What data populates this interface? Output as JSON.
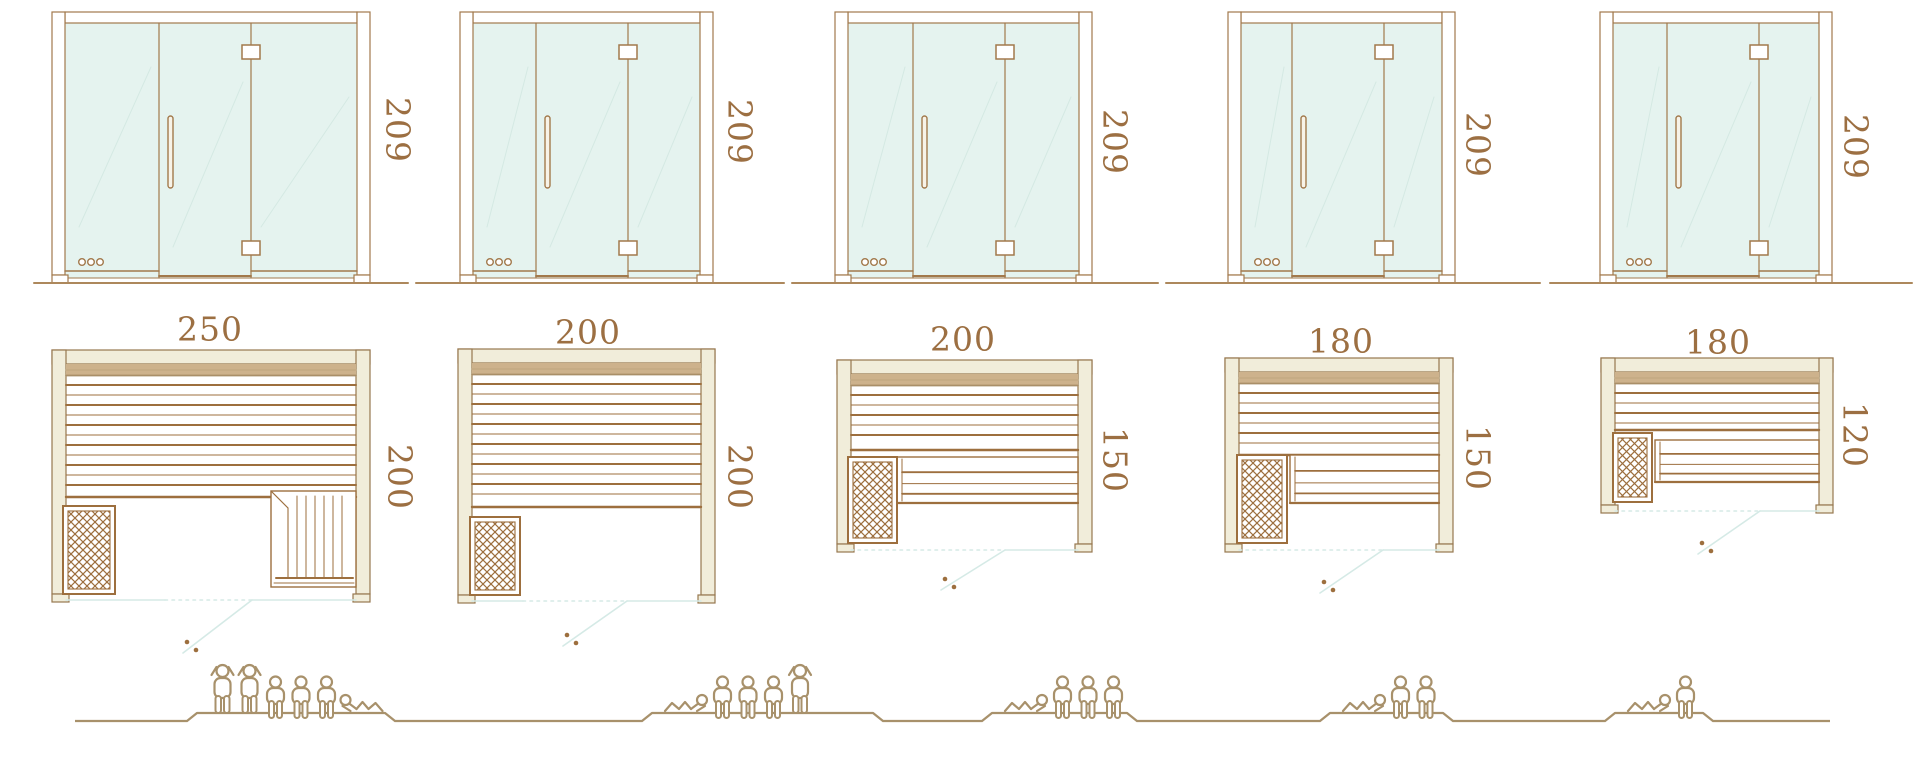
{
  "diagram": {
    "type": "sauna-size-comparison",
    "views": {
      "top": "front-elevation",
      "middle": "floor-plan",
      "bottom": "capacity-figures"
    },
    "models": [
      {
        "id": "250x200",
        "door_height": "209",
        "plan_width": "250",
        "plan_depth": "200",
        "capacity": {
          "standing": 2,
          "sitting": 3,
          "lying": 1
        },
        "features": {
          "heater": true,
          "main_bench": true,
          "corner_bench": true,
          "lower_bench": false
        }
      },
      {
        "id": "200x200",
        "door_height": "209",
        "plan_width": "200",
        "plan_depth": "200",
        "capacity": {
          "standing": 1,
          "sitting": 3,
          "lying": 1
        },
        "features": {
          "heater": true,
          "main_bench": true,
          "corner_bench": false,
          "lower_bench": false
        }
      },
      {
        "id": "200x150",
        "door_height": "209",
        "plan_width": "200",
        "plan_depth": "150",
        "capacity": {
          "standing": 0,
          "sitting": 3,
          "lying": 1
        },
        "features": {
          "heater": true,
          "main_bench": true,
          "corner_bench": false,
          "lower_bench": true
        }
      },
      {
        "id": "180x150",
        "door_height": "209",
        "plan_width": "180",
        "plan_depth": "150",
        "capacity": {
          "standing": 0,
          "sitting": 2,
          "lying": 1
        },
        "features": {
          "heater": true,
          "main_bench": true,
          "corner_bench": false,
          "lower_bench": true
        }
      },
      {
        "id": "180x120",
        "door_height": "209",
        "plan_width": "180",
        "plan_depth": "120",
        "capacity": {
          "standing": 0,
          "sitting": 1,
          "lying": 1
        },
        "features": {
          "heater": true,
          "main_bench": true,
          "corner_bench": false,
          "lower_bench": true
        }
      }
    ],
    "icons": {
      "people": [
        "person-standing-icon",
        "person-sitting-icon",
        "person-lying-icon"
      ],
      "equipment": [
        "heater-icon",
        "door-hinge-icon",
        "door-handle-icon",
        "vent-dots-icon"
      ]
    }
  },
  "palette": {
    "background": "#ffffff",
    "outline_brown": "#a2794c",
    "plan_line_brown": "#9d6f3e",
    "wall_stroke": "#97784f",
    "wall_fill": "#f1edda",
    "wall_band_fill": "#cdb28c",
    "dimension_text": "#9c6f42",
    "glass_fill": "#e5f3ef",
    "glass_reflection": "#d3e8e2",
    "door_swing_line": "#d5eae6",
    "people_line": "#a8916b",
    "ground_line": "#ad885c"
  }
}
